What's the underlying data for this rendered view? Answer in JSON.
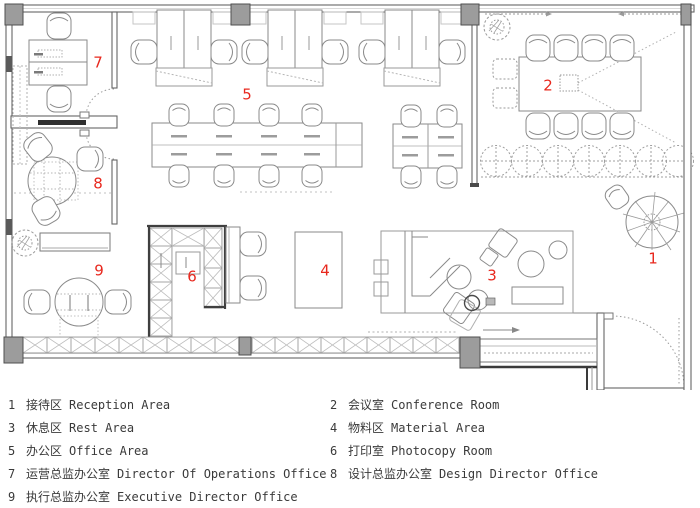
{
  "colors": {
    "accent": "#e8281e",
    "pillar": "#9c9c9c",
    "wall": "#666666",
    "furn": "#8a8a8a",
    "text": "#3a3a3a",
    "bg": "#ffffff"
  },
  "plan": {
    "area_labels": [
      {
        "num": "1",
        "x": 653,
        "y": 259
      },
      {
        "num": "2",
        "x": 548,
        "y": 86
      },
      {
        "num": "3",
        "x": 492,
        "y": 276
      },
      {
        "num": "4",
        "x": 325,
        "y": 271
      },
      {
        "num": "5",
        "x": 247,
        "y": 95
      },
      {
        "num": "6",
        "x": 192,
        "y": 277
      },
      {
        "num": "7",
        "x": 98,
        "y": 63
      },
      {
        "num": "8",
        "x": 98,
        "y": 184
      },
      {
        "num": "9",
        "x": 99,
        "y": 271
      }
    ]
  },
  "legend": {
    "left": [
      {
        "num": "1",
        "zh": "接待区",
        "en": "Reception Area"
      },
      {
        "num": "3",
        "zh": "休息区",
        "en": "Rest Area"
      },
      {
        "num": "5",
        "zh": "办公区",
        "en": "Office Area"
      },
      {
        "num": "7",
        "zh": "运营总监办公室",
        "en": "Director Of Operations Office"
      },
      {
        "num": "9",
        "zh": "执行总监办公室",
        "en": "Executive Director Office"
      }
    ],
    "right": [
      {
        "num": "2",
        "zh": "会议室",
        "en": "Conference Room"
      },
      {
        "num": "4",
        "zh": "物料区",
        "en": "Material Area"
      },
      {
        "num": "6",
        "zh": "打印室",
        "en": "Photocopy Room"
      },
      {
        "num": "8",
        "zh": "设计总监办公室",
        "en": "Design Director Office"
      }
    ]
  }
}
